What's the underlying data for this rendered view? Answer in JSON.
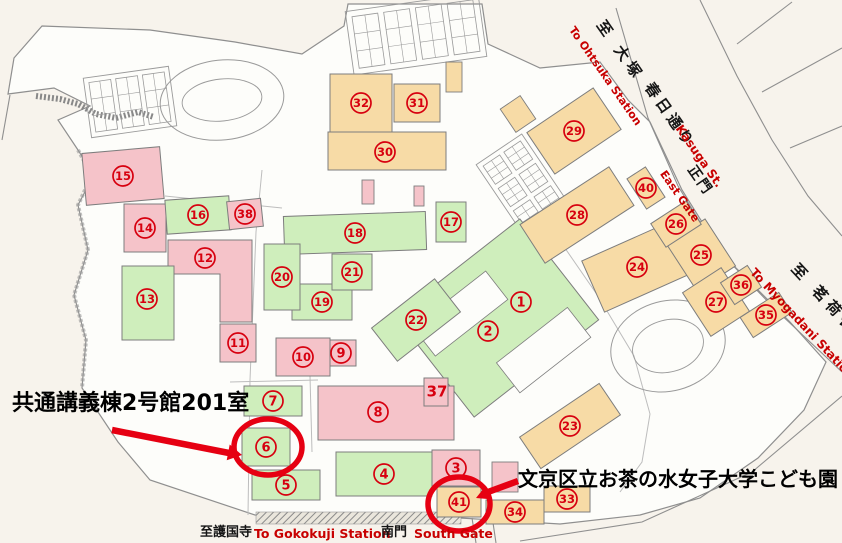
{
  "colors": {
    "bg": "#f7f3ec",
    "campus": "#fdfdfa",
    "pink": "#f5c3c9",
    "green": "#cfeebc",
    "tan": "#f7dba6",
    "building_outline": "#7d7d7d",
    "marker_red": "#d7000f",
    "highlight_red": "#e60012",
    "road": "#8f8f8f",
    "path": "#bdbdbd"
  },
  "streets": {
    "ohtsuka": {
      "jp": "至 大塚",
      "en": "To Ohtsuka Station"
    },
    "kasuga": {
      "jp": "春日通り",
      "en": "Kasuga St."
    },
    "east_gate": {
      "jp": "正門",
      "en": "East Gate"
    },
    "myogadani": {
      "jp": "至 茗荷谷",
      "en": "To Myogadani Station"
    },
    "gokokuji": {
      "jp": "至護国寺",
      "en": "To Gokokuji Station"
    },
    "south_gate": {
      "jp": "南門",
      "en": "South Gate"
    }
  },
  "annotations": {
    "room": {
      "text": "共通講義棟2号館201室",
      "points_to_building": "6"
    },
    "kodomoen": {
      "text": "文京区立お茶の水女子大学こども園",
      "points_to_building": "41"
    }
  },
  "buildings": [
    {
      "n": "1",
      "marker": [
        521,
        302
      ]
    },
    {
      "n": "2",
      "marker": [
        488,
        331
      ]
    },
    {
      "n": "3",
      "color": "pink",
      "rect": [
        432,
        450,
        48,
        36
      ]
    },
    {
      "n": "4",
      "color": "green",
      "rect": [
        336,
        452,
        96,
        44
      ]
    },
    {
      "n": "5",
      "color": "green",
      "rect": [
        252,
        470,
        68,
        30
      ]
    },
    {
      "n": "6",
      "color": "green",
      "rect": [
        242,
        428,
        48,
        38
      ]
    },
    {
      "n": "7",
      "color": "green",
      "rect": [
        244,
        386,
        58,
        30
      ]
    },
    {
      "n": "8",
      "color": "pink",
      "rect": [
        318,
        386,
        136,
        54
      ],
      "marker": [
        378,
        412
      ]
    },
    {
      "n": "9",
      "color": "pink",
      "rect": [
        326,
        340,
        30,
        26
      ]
    },
    {
      "n": "10",
      "color": "pink",
      "rect": [
        276,
        338,
        54,
        38
      ]
    },
    {
      "n": "11",
      "color": "pink",
      "rect": [
        220,
        324,
        36,
        38
      ]
    },
    {
      "n": "12",
      "color": "pink",
      "poly": [
        [
          168,
          240
        ],
        [
          252,
          240
        ],
        [
          252,
          322
        ],
        [
          220,
          322
        ],
        [
          220,
          274
        ],
        [
          168,
          274
        ]
      ],
      "marker": [
        205,
        258
      ]
    },
    {
      "n": "13",
      "color": "green",
      "rect": [
        122,
        266,
        52,
        74
      ],
      "marker": [
        147,
        299
      ]
    },
    {
      "n": "14",
      "color": "pink",
      "rect": [
        124,
        204,
        42,
        48
      ]
    },
    {
      "n": "15",
      "color": "pink",
      "rect": [
        84,
        150,
        78,
        52
      ],
      "rot": -5
    },
    {
      "n": "16",
      "color": "green",
      "rect": [
        166,
        198,
        64,
        34
      ],
      "rot": -4
    },
    {
      "n": "17",
      "color": "green",
      "rect": [
        436,
        202,
        30,
        40
      ]
    },
    {
      "n": "18",
      "color": "green",
      "rect": [
        284,
        214,
        142,
        38
      ],
      "rot": -2
    },
    {
      "n": "19",
      "color": "green",
      "rect": [
        292,
        284,
        60,
        36
      ]
    },
    {
      "n": "20",
      "color": "green",
      "rect": [
        264,
        244,
        36,
        66
      ]
    },
    {
      "n": "21",
      "color": "green",
      "rect": [
        332,
        254,
        40,
        36
      ]
    },
    {
      "n": "22",
      "color": "green",
      "rect": [
        376,
        299,
        80,
        42
      ],
      "rot": -38
    },
    {
      "n": "23",
      "color": "tan",
      "rect": [
        522,
        407,
        96,
        38
      ],
      "rot": -34
    },
    {
      "n": "24",
      "color": "tan",
      "rect": [
        589,
        239,
        96,
        56
      ],
      "rot": -24
    },
    {
      "n": "25",
      "color": "tan",
      "rect": [
        678,
        227,
        46,
        56
      ],
      "rot": -33
    },
    {
      "n": "26",
      "color": "tan",
      "rect": [
        655,
        210,
        42,
        28
      ],
      "rot": -33
    },
    {
      "n": "27",
      "color": "tan",
      "rect": [
        693,
        276,
        46,
        52
      ],
      "rot": -33
    },
    {
      "n": "28",
      "color": "tan",
      "rect": [
        524,
        192,
        106,
        46
      ],
      "rot": -33
    },
    {
      "n": "29",
      "color": "tan",
      "rect": [
        534,
        106,
        80,
        50
      ],
      "rot": -34
    },
    {
      "n": "30",
      "color": "tan",
      "rect": [
        328,
        132,
        118,
        38
      ],
      "marker": [
        385,
        152
      ]
    },
    {
      "n": "31",
      "color": "tan",
      "rect": [
        394,
        84,
        46,
        38
      ]
    },
    {
      "n": "32",
      "color": "tan",
      "rect": [
        330,
        74,
        62,
        58
      ]
    },
    {
      "n": "33",
      "color": "tan",
      "rect": [
        544,
        486,
        46,
        26
      ]
    },
    {
      "n": "34",
      "color": "tan",
      "rect": [
        486,
        500,
        58,
        24
      ]
    },
    {
      "n": "35",
      "color": "tan",
      "rect": [
        743,
        303,
        46,
        24
      ],
      "rot": -33
    },
    {
      "n": "36",
      "color": "tan",
      "rect": [
        725,
        272,
        32,
        26
      ],
      "rot": -33
    },
    {
      "n": "37",
      "color": "pink",
      "rect": [
        424,
        378,
        24,
        28
      ],
      "plain": true,
      "marker": [
        437,
        391
      ]
    },
    {
      "n": "38",
      "color": "pink",
      "rect": [
        228,
        200,
        34,
        28
      ],
      "rot": -6
    },
    {
      "n": "40",
      "color": "tan",
      "rect": [
        635,
        170,
        22,
        36
      ],
      "rot": -33
    },
    {
      "n": "41",
      "color": "tan",
      "rect": [
        437,
        487,
        44,
        30
      ]
    }
  ],
  "extras": [
    {
      "color": "tan",
      "rect": [
        506,
        100,
        24,
        28
      ],
      "rot": -34
    },
    {
      "color": "tan",
      "rect": [
        446,
        62,
        16,
        30
      ]
    },
    {
      "color": "pink",
      "rect": [
        492,
        462,
        26,
        30
      ]
    },
    {
      "color": "pink",
      "rect": [
        362,
        180,
        12,
        24
      ]
    },
    {
      "color": "pink",
      "rect": [
        414,
        186,
        10,
        20
      ]
    }
  ],
  "main_complex": {
    "cx": 497,
    "cy": 318,
    "w": 158,
    "h": 128,
    "rot": -38,
    "courtyards": [
      [
        471,
        292,
        92,
        36
      ],
      [
        514,
        372,
        90,
        38
      ]
    ]
  },
  "sports": {
    "tennis": [
      {
        "cx": 130,
        "cy": 102,
        "cols": 3,
        "rows": 1,
        "cw": 22,
        "ch": 50,
        "gap": 5,
        "rot": -8
      },
      {
        "cx": 416,
        "cy": 34,
        "cols": 4,
        "rows": 1,
        "cw": 26,
        "ch": 52,
        "gap": 6,
        "rot": -8
      },
      {
        "cx": 523,
        "cy": 185,
        "cols": 2,
        "rows": 3,
        "cw": 20,
        "ch": 22,
        "gap": 5,
        "rot": -34
      }
    ],
    "tracks": [
      {
        "cx": 222,
        "cy": 100,
        "rx": 62,
        "ry": 40,
        "irx": 40,
        "iry": 21,
        "rot": -6
      },
      {
        "cx": 668,
        "cy": 346,
        "rx": 58,
        "ry": 45,
        "irx": 36,
        "iry": 26,
        "rot": -15
      }
    ]
  },
  "outline": [
    [
      42,
      26
    ],
    [
      150,
      30
    ],
    [
      235,
      42
    ],
    [
      302,
      54
    ],
    [
      344,
      26
    ],
    [
      348,
      4
    ],
    [
      482,
      4
    ],
    [
      488,
      44
    ],
    [
      540,
      68
    ],
    [
      600,
      62
    ],
    [
      628,
      100
    ],
    [
      650,
      122
    ],
    [
      682,
      190
    ],
    [
      722,
      254
    ],
    [
      790,
      322
    ],
    [
      826,
      362
    ],
    [
      804,
      410
    ],
    [
      758,
      458
    ],
    [
      700,
      498
    ],
    [
      640,
      515
    ],
    [
      560,
      524
    ],
    [
      460,
      518
    ],
    [
      255,
      515
    ],
    [
      150,
      480
    ],
    [
      118,
      442
    ],
    [
      82,
      388
    ],
    [
      86,
      340
    ],
    [
      74,
      295
    ],
    [
      88,
      250
    ],
    [
      78,
      205
    ],
    [
      94,
      175
    ],
    [
      78,
      150
    ],
    [
      58,
      120
    ],
    [
      90,
      106
    ],
    [
      54,
      88
    ],
    [
      8,
      94
    ],
    [
      14,
      58
    ]
  ],
  "roads": [
    [
      [
        616,
        8
      ],
      [
        648,
        118
      ],
      [
        678,
        186
      ],
      [
        716,
        248
      ],
      [
        776,
        310
      ],
      [
        842,
        372
      ]
    ],
    [
      [
        700,
        0
      ],
      [
        737,
        76
      ],
      [
        772,
        140
      ],
      [
        808,
        196
      ],
      [
        842,
        236
      ]
    ],
    [
      [
        737,
        44
      ],
      [
        792,
        2
      ]
    ],
    [
      [
        762,
        92
      ],
      [
        842,
        48
      ]
    ],
    [
      [
        790,
        148
      ],
      [
        842,
        126
      ]
    ],
    [
      [
        842,
        396
      ],
      [
        752,
        472
      ],
      [
        642,
        522
      ],
      [
        520,
        541
      ]
    ],
    [
      [
        472,
        518
      ],
      [
        476,
        543
      ]
    ],
    [
      [
        492,
        516
      ],
      [
        496,
        543
      ]
    ],
    [
      [
        10,
        95
      ],
      [
        2,
        140
      ]
    ]
  ],
  "paths": [
    [
      [
        262,
        170
      ],
      [
        256,
        232
      ],
      [
        250,
        380
      ],
      [
        248,
        515
      ]
    ],
    [
      [
        230,
        382
      ],
      [
        318,
        380
      ]
    ],
    [
      [
        558,
        238
      ],
      [
        598,
        296
      ],
      [
        634,
        356
      ],
      [
        650,
        414
      ],
      [
        642,
        462
      ],
      [
        620,
        492
      ]
    ],
    [
      [
        165,
        196
      ],
      [
        282,
        208
      ]
    ],
    [
      [
        310,
        376
      ],
      [
        312,
        452
      ]
    ]
  ],
  "stream": [
    [
      36,
      96
    ],
    [
      60,
      99
    ],
    [
      78,
      104
    ],
    [
      96,
      114
    ],
    [
      116,
      118
    ],
    [
      138,
      112
    ],
    [
      154,
      117
    ]
  ],
  "west_hatch": [
    [
      78,
      150
    ],
    [
      92,
      175
    ],
    [
      78,
      205
    ],
    [
      88,
      250
    ],
    [
      74,
      295
    ],
    [
      86,
      340
    ],
    [
      82,
      388
    ]
  ],
  "hatch_strip": [
    256,
    512,
    205,
    12
  ],
  "highlights": [
    {
      "building": "6",
      "ellipse": [
        268,
        447,
        34,
        28
      ]
    },
    {
      "building": "41",
      "ellipse": [
        459,
        504,
        31,
        27
      ]
    }
  ],
  "arrows": [
    {
      "building": "6",
      "line": [
        [
          112,
          430
        ],
        [
          229,
          453
        ]
      ],
      "head": [
        [
          242,
          455
        ],
        [
          226.7,
          460.3
        ],
        [
          229.7,
          444.5
        ]
      ]
    },
    {
      "building": "41",
      "line": [
        [
          518,
          481
        ],
        [
          488,
          492
        ]
      ],
      "head": [
        [
          476,
          498
        ],
        [
          485.9,
          485.6
        ],
        [
          491.9,
          499.4
        ]
      ]
    }
  ]
}
